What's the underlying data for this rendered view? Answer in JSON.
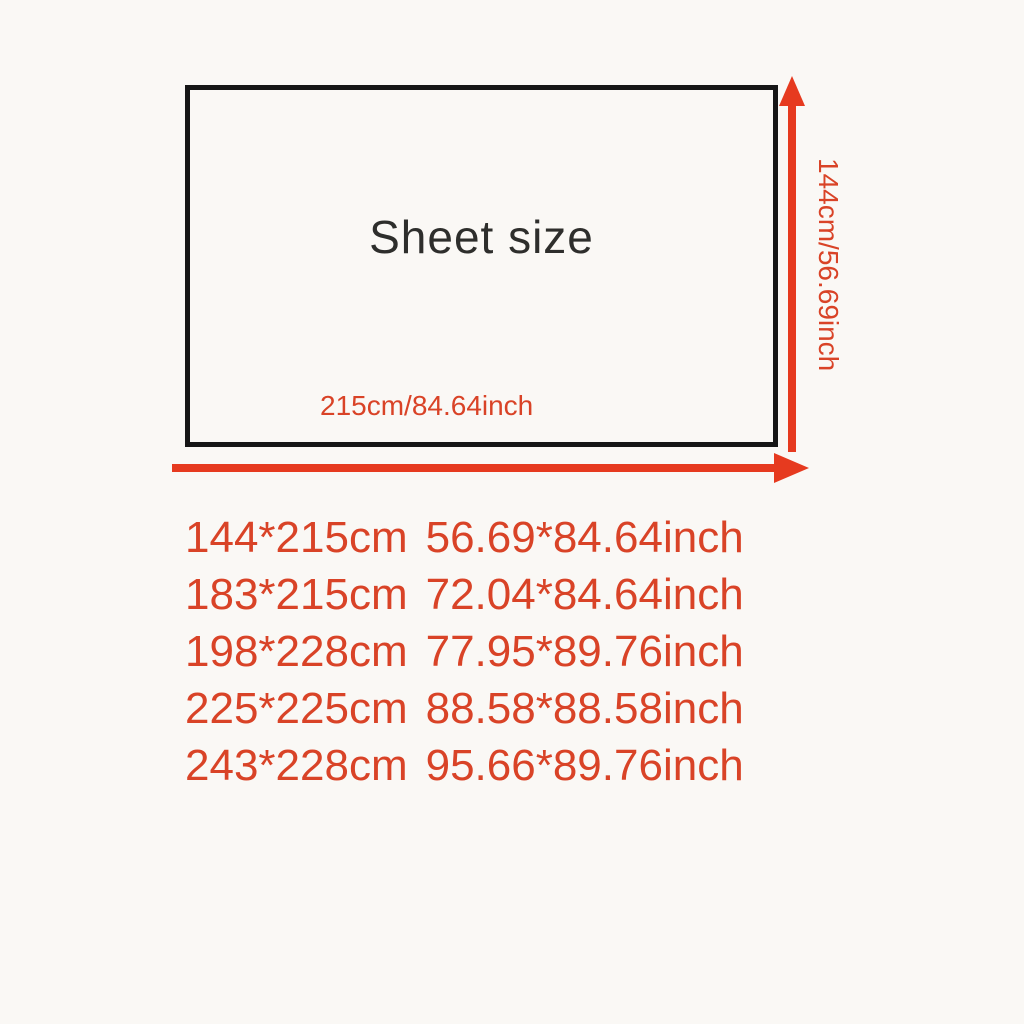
{
  "diagram": {
    "box_label": "Sheet size",
    "width_label": "215cm/84.64inch",
    "height_label": "144cm/56.69inch"
  },
  "size_list": [
    {
      "cm": "144*215cm",
      "inch": "56.69*84.64inch"
    },
    {
      "cm": "183*215cm",
      "inch": "72.04*84.64inch"
    },
    {
      "cm": "198*228cm",
      "inch": "77.95*89.76inch"
    },
    {
      "cm": "225*225cm",
      "inch": "88.58*88.58inch"
    },
    {
      "cm": "243*228cm",
      "inch": "95.66*89.76inch"
    }
  ],
  "colors": {
    "background": "#faf8f5",
    "box_border": "#161616",
    "title_dark": "#2e2e2c",
    "text_red": "#d94327",
    "arrow_red": "#e63a1f"
  }
}
